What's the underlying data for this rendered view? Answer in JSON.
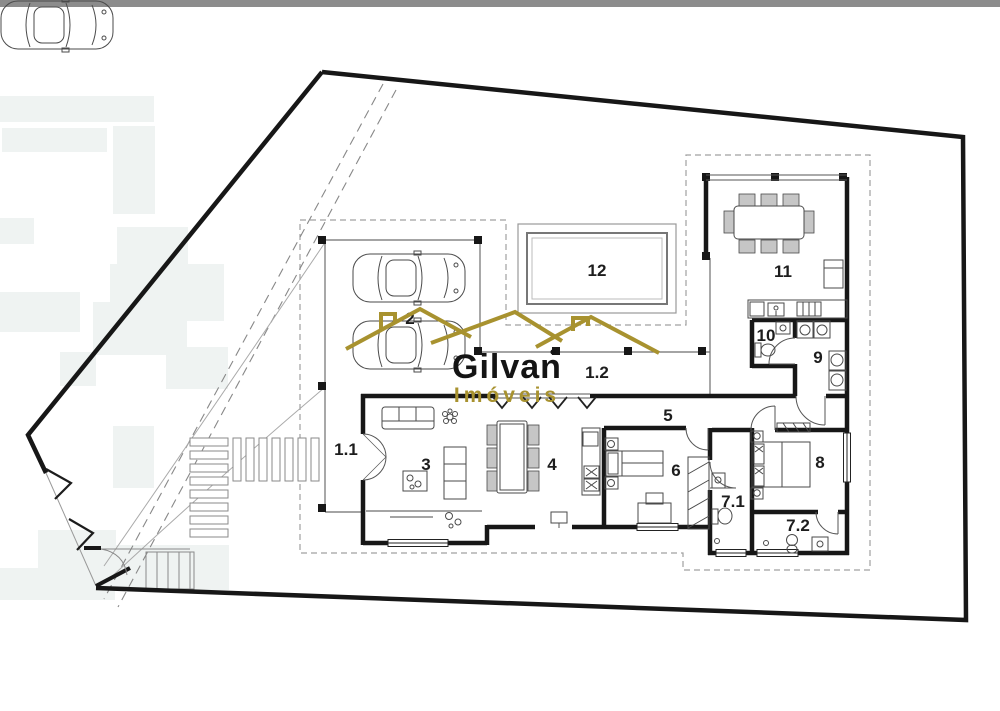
{
  "page": {
    "background": "#ffffff",
    "top_strip_color": "#8c8c8c"
  },
  "logo": {
    "name": "Gilvan",
    "tagline": "Imóveis",
    "accent_color": "#a8922f",
    "text_color": "#141414"
  },
  "floorplan": {
    "wall_color": "#171717",
    "labels": {
      "r1_1": "1.1",
      "r1_2": "1.2",
      "r2": "2",
      "r3": "3",
      "r4": "4",
      "r5": "5",
      "r6": "6",
      "r7_1": "7.1",
      "r7_2": "7.2",
      "r8": "8",
      "r9": "9",
      "r10": "10",
      "r11": "11",
      "r12": "12"
    }
  }
}
